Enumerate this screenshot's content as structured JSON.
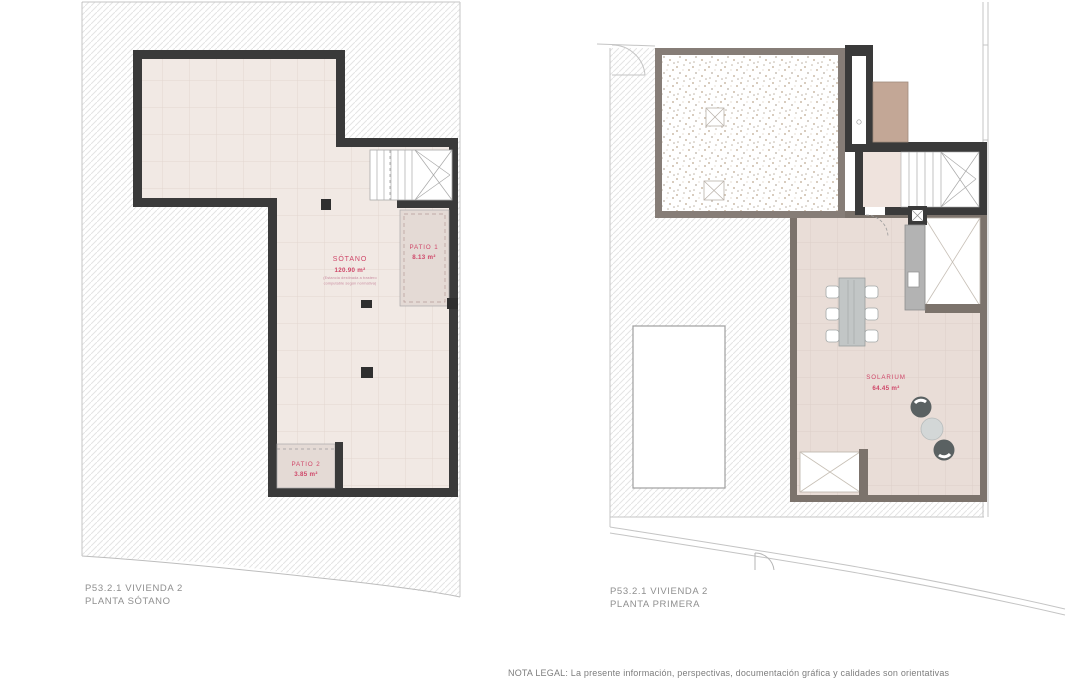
{
  "colors": {
    "wall_dark": "#3a3a3a",
    "wall_terrace": "#867d77",
    "wall_room": "#7c736c",
    "floor_pink": "#f1e9e4",
    "floor_solarium": "#e9ddd7",
    "patio_fill": "#e4dad5",
    "area_label_red": "#cf4668",
    "note_red": "#c98ca0",
    "tan_block": "#c3a796",
    "boundary_gray": "#c4c4c4"
  },
  "left_plan": {
    "title_line1": "P53.2.1 VIVIENDA 2",
    "title_line2": "PLANTA SÓTANO",
    "rooms": {
      "sotano": {
        "name": "SÓTANO",
        "area": "120.90 m²",
        "note_line1": "(Estancia destinada a trastero",
        "note_line2": "computable según normativa)"
      },
      "patio1": {
        "name": "PATIO 1",
        "area": "8.13 m²"
      },
      "patio2": {
        "name": "PATIO 2",
        "area": "3.85 m²"
      }
    }
  },
  "right_plan": {
    "title_line1": "P53.2.1 VIVIENDA 2",
    "title_line2": "PLANTA PRIMERA",
    "rooms": {
      "solarium": {
        "name": "SOLARIUM",
        "area": "64.45 m²"
      }
    }
  },
  "footer": {
    "legal_note": "NOTA LEGAL: La presente información, perspectivas, documentación gráfica y calidades son orientativas"
  }
}
